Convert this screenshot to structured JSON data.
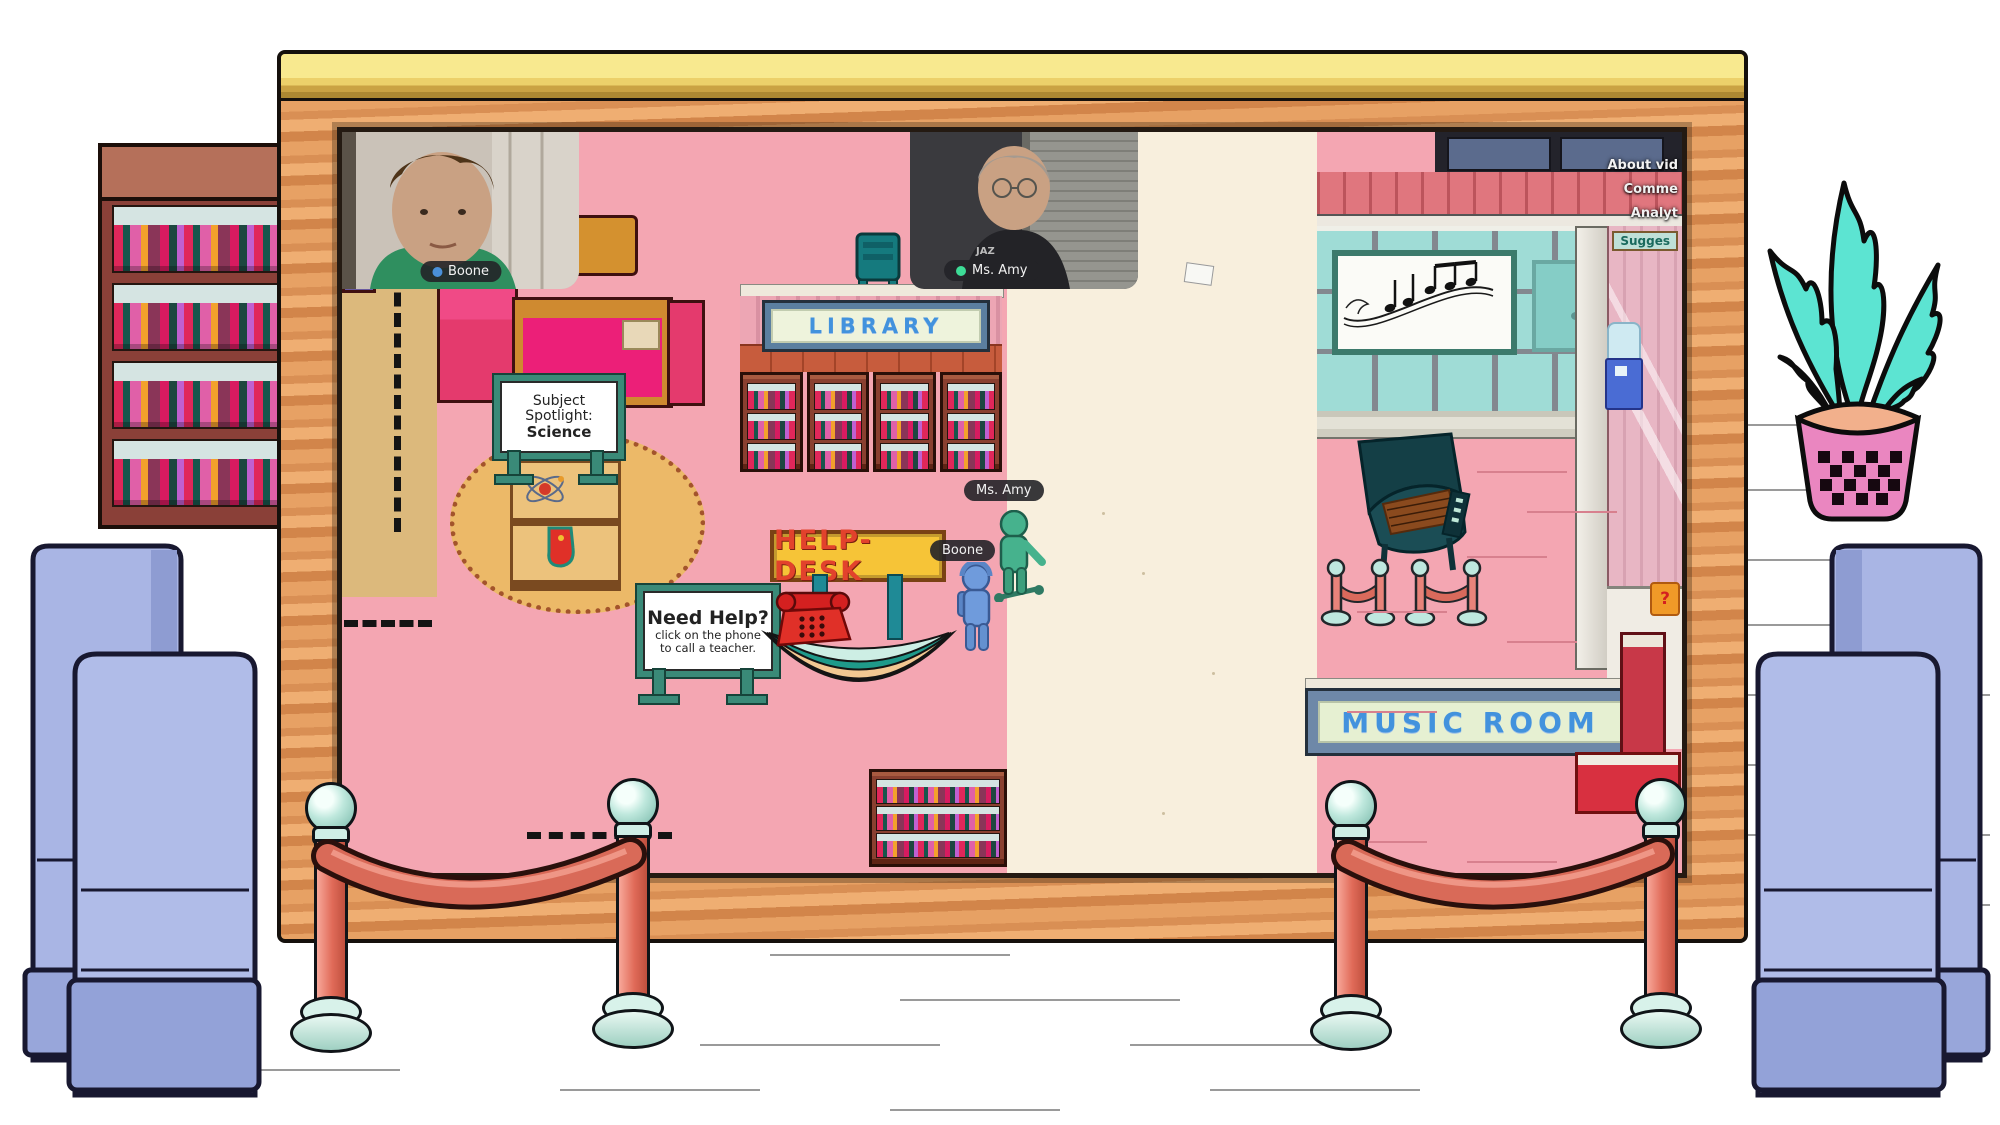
{
  "videos": {
    "boone": {
      "label": "Boone"
    },
    "amy": {
      "label": "Ms. Amy",
      "shirt_text": "JAZ"
    }
  },
  "map": {
    "library_sign": "LIBRARY",
    "music_room_sign": "MUSIC ROOM",
    "help_desk_sign": "HELP-DESK",
    "spotlight_sign": {
      "line1": "Subject",
      "line2": "Spotlight:",
      "line3": "Science"
    },
    "need_help_sign": {
      "title": "Need Help?",
      "line1": "click on the phone",
      "line2": "to call a teacher."
    },
    "question_block": "?"
  },
  "avatars": {
    "amy": {
      "label": "Ms. Amy"
    },
    "boone": {
      "label": "Boone"
    }
  },
  "menu": {
    "items": [
      {
        "label": "About vid"
      },
      {
        "label": "Comme"
      },
      {
        "label": "Analyt"
      },
      {
        "label": "Sugges"
      }
    ]
  },
  "colors": {
    "sign_text_blue": "#4292dd",
    "help_desk_bg": "#f6c437",
    "help_desk_text": "#e2422c",
    "avatar_green": "#46b28d",
    "avatar_blue": "#6f9bdc",
    "boone_dot": "#4a90d9",
    "amy_dot": "#3ddc97",
    "frame_orange": "#e09a62",
    "frame_top_yellow": "#f6e387",
    "room_pink": "#f4a6b2",
    "corridor_cream": "#f8efdd",
    "rope_red": "#d96a58",
    "plant_teal": "#5ce4d2",
    "booth_blue": "#a9b5e4"
  }
}
